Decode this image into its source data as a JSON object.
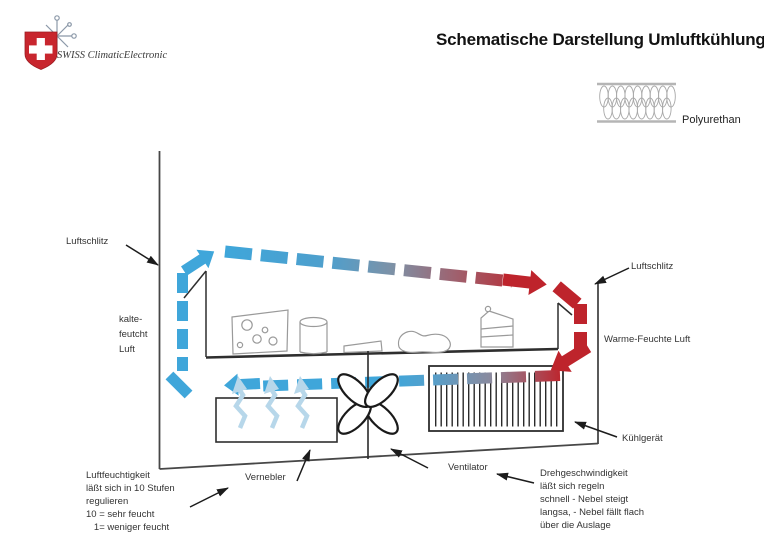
{
  "header": {
    "brand": "SWISS ClimaticElectronic",
    "title": "Schematische Darstellung Umluftkühlung"
  },
  "legend": {
    "polyurethane_label": "Polyurethan"
  },
  "diagram": {
    "labels": {
      "luftschlitz_left": "Luftschlitz",
      "luftschlitz_right": "Luftschlitz",
      "kalte_feucht_luft": "kalte-\nfeutcht\nLuft",
      "warme_feuchte_luft": "Warme-Feuchte Luft",
      "kuehlgeraet": "Kühlgerät",
      "ventilator": "Ventilator",
      "vernebler": "Vernebler",
      "luftfeuchtigkeit_note": "Luftfeuchtigkeit\nläßt sich in 10 Stufen\nregulieren\n10 = sehr feucht\n   1= weniger feucht",
      "drehgeschwindigkeit_note": "Drehgeschwindigkeit\nläßt sich regeln\nschnell - Nebel steigt\nlangsa, - Nebel fällt flach\nüber die Auslage"
    },
    "colors": {
      "cold_air": "#3fa6da",
      "warm_air": "#be242c",
      "mist": "#b7d7ea",
      "logo_red": "#c8262e",
      "outline": "#2a2a2a"
    }
  }
}
